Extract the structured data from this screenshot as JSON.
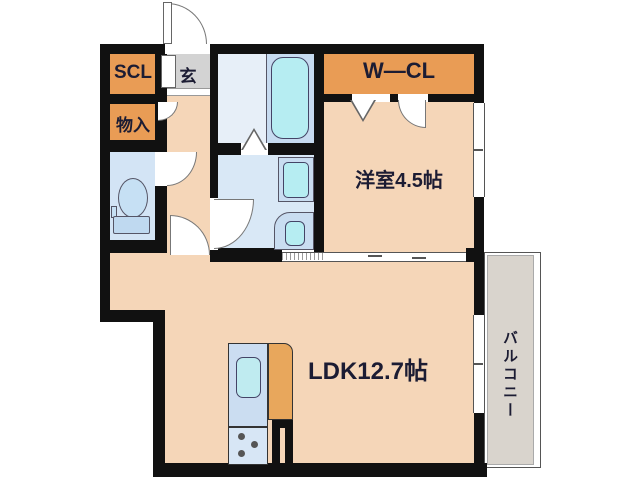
{
  "plan_type": "apartment-floorplan",
  "rooms": {
    "shoe_closet": {
      "label": "SCL"
    },
    "entrance": {
      "label": "玄"
    },
    "storage": {
      "label": "物入"
    },
    "walk_in_closet": {
      "label": "W—CL"
    },
    "western_room": {
      "label": "洋室4.5帖",
      "size_jo": 4.5
    },
    "ldk": {
      "label": "LDK12.7帖",
      "size_jo": 12.7
    },
    "balcony": {
      "label": "バルコニー"
    }
  },
  "fixtures": [
    "toilet",
    "bathtub",
    "washbasin",
    "washing-machine-pan",
    "kitchen-sink",
    "stove-burners"
  ],
  "colors": {
    "wall": "#111111",
    "floor_beige": "#F5D6B8",
    "closet_orange": "#E99C55",
    "counter_orange": "#E8A75C",
    "wet_area_blue": "#D9E8F6",
    "toilet_blue": "#D3E4F5",
    "bath_panel_blue": "#C7DBF0",
    "fixture_cyan": "#B6EDF2",
    "entrance_gray": "#D3D3D3",
    "balcony_gray": "#D9D4CD"
  }
}
